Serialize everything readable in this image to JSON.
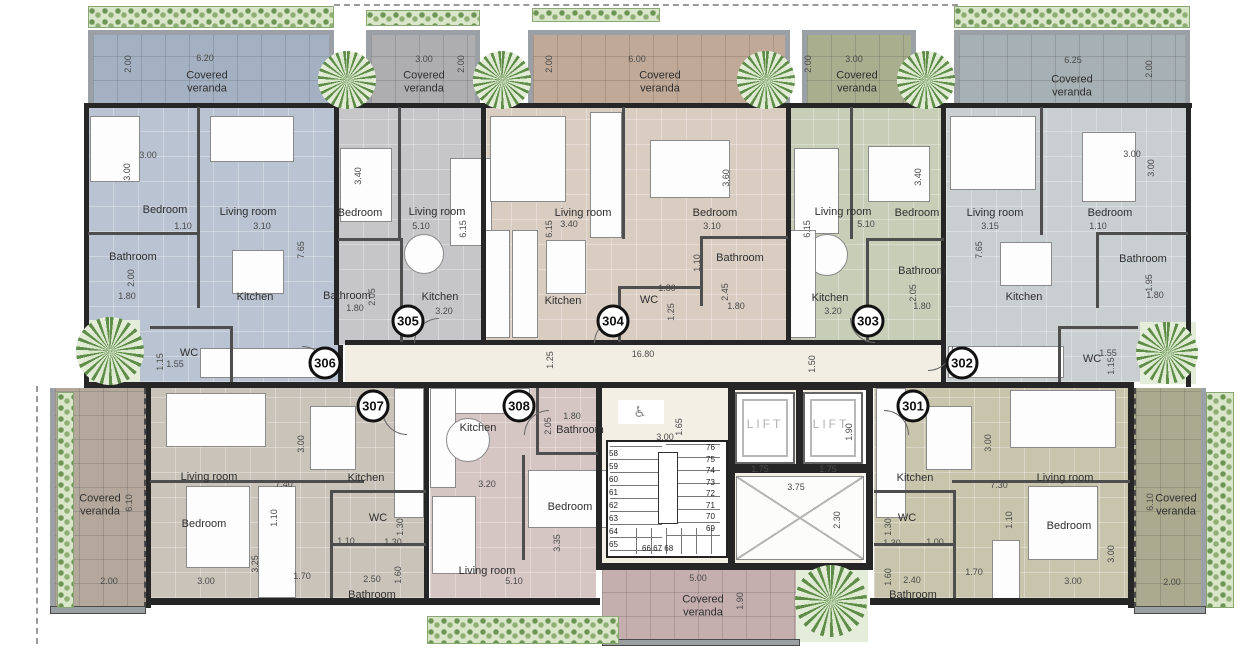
{
  "palette": {
    "unit301": "#c9c5ac",
    "unit302": "#c9ced0",
    "unit303": "#c8cdb8",
    "unit304": "#d9ccc1",
    "unit305": "#c6c6c8",
    "unit306": "#b9c3d1",
    "unit307": "#cac3ba",
    "unit308": "#d5c6c3",
    "veranda301": "#abaa8e",
    "veranda302": "#a7b0b4",
    "veranda303": "#a9ae8e",
    "veranda304": "#c0a996",
    "veranda305": "#aeaeb0",
    "veranda306": "#a4b1c3",
    "veranda307": "#b3a89b",
    "veranda308": "#c4aeae",
    "corridor": "#f2eee3",
    "wall": "#262626",
    "hedge_green": "#6c9454",
    "tree_green": "#5f8c49"
  },
  "corridor": {
    "length": "16.80",
    "width": "1.50",
    "offset": "1.25"
  },
  "core": {
    "lift": "LIFT",
    "lift_w": "1.75",
    "lift2_w": "1.75",
    "lift_d": "1.90",
    "stair_w": "3.00",
    "landing_d": "1.65",
    "shaft_w": "3.75",
    "shaft_d": "2.30",
    "steps_left": "58\n59\n60\n61\n62\n63\n64\n65",
    "steps_right": "76\n75\n74\n73\n72\n71\n70\n69",
    "steps_bottom": "66  67  68",
    "accessible_icon": "♿",
    "veranda_label": "Covered veranda",
    "veranda_w": "5.00",
    "veranda_d": "1.90"
  },
  "units": {
    "u306": {
      "number": "306",
      "veranda_label": "Covered veranda",
      "veranda_w": "6.20",
      "veranda_d": "2.00",
      "bedroom": "Bedroom",
      "bedroom_w": "3.00",
      "bedroom_h": "3.00",
      "living": "Living room",
      "living_w": "3.10",
      "living_off": "1.10",
      "living_d": "7.65",
      "bathroom": "Bathroom",
      "bathroom_h": "2.00",
      "bathroom_w": "1.80",
      "kitchen": "Kitchen",
      "wc": "WC",
      "wc_w": "1.55",
      "wc_h": "1.15"
    },
    "u305": {
      "number": "305",
      "veranda_label": "Covered veranda",
      "veranda_w": "3.00",
      "veranda_d": "2.00",
      "bedroom": "Bedroom",
      "bedroom_h": "3.40",
      "living": "Living room",
      "living_w": "5.10",
      "living_d": "6.15",
      "bathroom": "Bathroom",
      "bathroom_w": "1.80",
      "bathroom_h": "2.05",
      "kitchen": "Kitchen",
      "kitchen_w": "3.20"
    },
    "u304": {
      "number": "304",
      "veranda_label": "Covered veranda",
      "veranda_w": "6.00",
      "veranda_d": "2.00",
      "living": "Living room",
      "living_w": "3.40",
      "living_d": "6.15",
      "bedroom": "Bedroom",
      "bedroom_w": "3.10",
      "bedroom_h": "3.60",
      "bathroom": "Bathroom",
      "bathroom_h": "2.45",
      "bathroom_w": "1.80",
      "bathroom_off": "1.10",
      "wc": "WC",
      "wc_w": "1.80",
      "wc_h": "1.25",
      "kitchen": "Kitchen"
    },
    "u303": {
      "number": "303",
      "veranda_label": "Covered veranda",
      "veranda_w": "3.00",
      "veranda_d": "2.00",
      "living": "Living room",
      "living_w": "5.10",
      "living_d": "6.15",
      "bedroom": "Bedroom",
      "bedroom_h": "3.40",
      "kitchen": "Kitchen",
      "kitchen_w": "3.20",
      "bathroom": "Bathroom",
      "bathroom_h": "2.05",
      "bathroom_w": "1.80"
    },
    "u302": {
      "number": "302",
      "veranda_label": "Covered veranda",
      "veranda_w": "6.25",
      "veranda_d": "2.00",
      "living": "Living room",
      "living_w": "3.15",
      "living_d": "7.65",
      "bedroom": "Bedroom",
      "bedroom_w": "3.00",
      "bedroom_h": "3.00",
      "bedroom_off": "1.10",
      "bathroom": "Bathroom",
      "bathroom_h": "1.95",
      "bathroom_w": "1.80",
      "kitchen": "Kitchen",
      "wc": "WC",
      "wc_w": "1.55",
      "wc_h": "1.15"
    },
    "u307": {
      "number": "307",
      "veranda_label": "Covered veranda",
      "veranda_w": "2.00",
      "veranda_d": "6.10",
      "living": "Living room",
      "living_w": "7.40",
      "living_h": "3.00",
      "kitchen": "Kitchen",
      "bedroom": "Bedroom",
      "bedroom_w": "3.00",
      "bedroom_h": "3.25",
      "bedroom_off": "1.10",
      "closet_w": "1.70",
      "wc": "WC",
      "wc_w": "1.10",
      "wc_w2": "1.30",
      "wc_h": "1.30",
      "bathroom": "Bathroom",
      "bathroom_w": "2.50",
      "bathroom_h": "1.60"
    },
    "u308": {
      "number": "308",
      "kitchen": "Kitchen",
      "kitchen_w": "3.20",
      "bathroom": "Bathroom",
      "bathroom_w": "1.80",
      "bathroom_h": "2.05",
      "bedroom": "Bedroom",
      "bedroom_h": "3.35",
      "living": "Living room",
      "living_w": "5.10"
    },
    "u301": {
      "number": "301",
      "veranda_label": "Covered veranda",
      "veranda_w": "2.00",
      "veranda_d": "6.10",
      "kitchen": "Kitchen",
      "living": "Living room",
      "living_w": "7.30",
      "living_h": "3.00",
      "wc": "WC",
      "wc_h": "1.30",
      "wc_w": "1.30",
      "wc_w2": "1.00",
      "bedroom": "Bedroom",
      "bedroom_w": "3.00",
      "bedroom_h": "3.00",
      "bedroom_off": "1.10",
      "closet_w": "1.70",
      "bathroom": "Bathroom",
      "bathroom_w": "2.40",
      "bathroom_h": "1.60"
    }
  }
}
